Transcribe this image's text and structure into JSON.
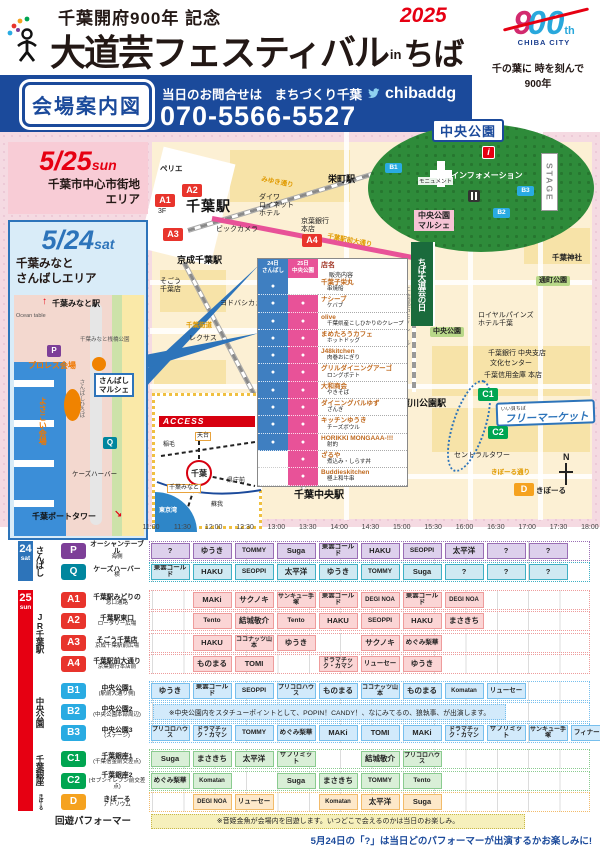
{
  "header": {
    "supertitle": "千葉開府900年 記念",
    "title_main": "大道芸フェスティバル",
    "title_in": "in",
    "title_chiba": "ちば",
    "year": "2025",
    "logo_9": "9",
    "logo_00": "00",
    "logo_th": "th",
    "logo_city": "CHIBA CITY",
    "tagline": "千の葉に 時を刻んで\n900年"
  },
  "contact": {
    "map_label": "会場案内図",
    "inquiry": "当日のお問合せは　まちづくり千葉",
    "twitter": "chibaddg",
    "phone": "070-5566-5527"
  },
  "sun_area": {
    "date": "5/25",
    "day": "sun",
    "area": "千葉市中心市街地\nエリア"
  },
  "sat_area": {
    "date": "5/24",
    "day": "sat",
    "area": "千葉みなと\nさんばしエリア"
  },
  "park": {
    "title": "中央公園",
    "stage": "STAGE",
    "monument": "モニュメント",
    "information": "インフォメーション",
    "info_i": "i",
    "marche": "中央公園\nマルシェ",
    "nobori": "ちば大道芸の日",
    "badges": [
      {
        "t": "B1",
        "x": 385,
        "y": 31,
        "c": "",
        "n": "park-point-b1"
      },
      {
        "t": "B3",
        "x": 517,
        "y": 54,
        "c": "",
        "n": "park-point-b3"
      },
      {
        "t": "B2",
        "x": 493,
        "y": 76,
        "c": "",
        "n": "park-point-b2"
      }
    ]
  },
  "map_texts": {
    "flea_small": "いい貝ちば",
    "flea_big": "フリーマーケット",
    "north": "N"
  },
  "main_map": {
    "labels": [
      {
        "t": "ペリエ",
        "x": 160,
        "y": 33,
        "c": "m-lbl-b",
        "n": "perie-label"
      },
      {
        "t": "千葉駅",
        "x": 186,
        "y": 66,
        "c": "m-sta-lg",
        "n": "chiba-station-label"
      },
      {
        "t": "京成千葉駅",
        "x": 177,
        "y": 123,
        "c": "m-sta",
        "n": "keisei-chiba-station-label"
      },
      {
        "t": "栄町駅",
        "x": 328,
        "y": 42,
        "c": "m-sta",
        "n": "sakaecho-station-label"
      },
      {
        "t": "千葉中央駅",
        "x": 294,
        "y": 358,
        "c": "m-sta-md",
        "n": "chiba-chuo-station-label"
      },
      {
        "t": "葭川公園駅",
        "x": 401,
        "y": 266,
        "c": "m-sta",
        "n": "yoshikawa-koen-station-label"
      },
      {
        "t": "3F",
        "x": 158,
        "y": 76,
        "c": "m-lbl",
        "n": "a1-floor-label"
      },
      {
        "t": "ビックカメラ",
        "x": 216,
        "y": 94,
        "c": "m-lbl",
        "n": "bic-camera-label"
      },
      {
        "t": "ダイワ\nロイネット\nホテル",
        "x": 259,
        "y": 62,
        "c": "m-lbl",
        "n": "daiwa-roynet-label"
      },
      {
        "t": "京葉銀行\n本店",
        "x": 301,
        "y": 86,
        "c": "m-lbl",
        "n": "keiyo-bank-label"
      },
      {
        "t": "そごう\n千葉店",
        "x": 160,
        "y": 146,
        "c": "m-lbl",
        "n": "sogo-label"
      },
      {
        "t": "ヨドバシカメラ",
        "x": 220,
        "y": 168,
        "c": "m-lbl",
        "n": "yodobashi-label"
      },
      {
        "t": "レクサス",
        "x": 189,
        "y": 203,
        "c": "m-lbl",
        "n": "lexus-label"
      },
      {
        "t": "千葉街道",
        "x": 186,
        "y": 190,
        "c": "m-road",
        "n": "chiba-kaido-label"
      },
      {
        "t": "みゆき通り",
        "x": 262,
        "y": 44,
        "c": "m-road m-road-rot",
        "n": "miyuki-street-label"
      },
      {
        "t": "千葉駅前大通り",
        "x": 328,
        "y": 101,
        "c": "m-road m-road-rot",
        "n": "ekimae-avenue-label"
      },
      {
        "t": "千葉神社",
        "x": 552,
        "y": 122,
        "c": "m-lbl-b",
        "n": "chiba-shrine-label"
      },
      {
        "t": "通町公園",
        "x": 536,
        "y": 144,
        "c": "m-chip",
        "n": "torichou-park-label"
      },
      {
        "t": "ロイヤルパインズ\nホテル千葉",
        "x": 478,
        "y": 180,
        "c": "m-lbl",
        "n": "royal-pines-label"
      },
      {
        "t": "中央公園",
        "x": 430,
        "y": 195,
        "c": "m-chip",
        "n": "chuo-park-small-label"
      },
      {
        "t": "千葉銀行 中央支店",
        "x": 488,
        "y": 218,
        "c": "m-lbl",
        "n": "chiba-bank-label"
      },
      {
        "t": "文化センター",
        "x": 490,
        "y": 228,
        "c": "m-lbl",
        "n": "culture-center-label"
      },
      {
        "t": "千葉信用金庫 本店",
        "x": 484,
        "y": 240,
        "c": "m-lbl",
        "n": "shinkin-bank-label"
      },
      {
        "t": "セントラルタワー",
        "x": 454,
        "y": 320,
        "c": "m-lbl",
        "n": "central-tower-label"
      },
      {
        "t": "きぼーる通り",
        "x": 491,
        "y": 337,
        "c": "m-road",
        "n": "qiball-street-label"
      },
      {
        "t": "きぼーる",
        "x": 536,
        "y": 355,
        "c": "m-lbl-b",
        "n": "qiball-label"
      },
      {
        "t": "千葉都市モノレール",
        "x": 402,
        "y": 155,
        "c": "m-v",
        "n": "monorail-label"
      }
    ],
    "badges": [
      {
        "t": "A1",
        "x": 155,
        "y": 62,
        "c": "bA",
        "n": "point-a1-badge"
      },
      {
        "t": "A2",
        "x": 182,
        "y": 52,
        "c": "bA",
        "n": "point-a2-badge"
      },
      {
        "t": "A3",
        "x": 163,
        "y": 96,
        "c": "bA",
        "n": "point-a3-badge"
      },
      {
        "t": "A4",
        "x": 302,
        "y": 102,
        "c": "bA",
        "n": "point-a4-badge"
      },
      {
        "t": "C1",
        "x": 478,
        "y": 256,
        "c": "bC",
        "n": "point-c1-badge"
      },
      {
        "t": "C2",
        "x": 488,
        "y": 294,
        "c": "bC",
        "n": "point-c2-badge"
      },
      {
        "t": "D",
        "x": 514,
        "y": 351,
        "c": "bD",
        "n": "point-d-badge"
      }
    ]
  },
  "minato": {
    "elements": [
      {
        "t": "↑",
        "x": 28,
        "y": 1,
        "c": "mm-arr",
        "n": "up-arrow-icon"
      },
      {
        "t": "千葉みなと駅",
        "x": 38,
        "y": 4,
        "c": "mm-sta",
        "n": "chibaminato-station-label"
      },
      {
        "t": "Ocean table",
        "x": 2,
        "y": 18,
        "c": "mm-tiny",
        "n": "ocean-table-label"
      },
      {
        "t": "千葉みなと桟橋公園",
        "x": 66,
        "y": 42,
        "c": "mm-tiny",
        "n": "sanbashi-park-label"
      },
      {
        "t": "P",
        "x": 33,
        "y": 50,
        "c": "mm-badge bP",
        "n": "point-p-badge"
      },
      {
        "t": "プロレス会場",
        "x": 14,
        "y": 66,
        "c": "mm-orange",
        "n": "wrestling-venue-label"
      },
      {
        "t": "さんばし\nマルシェ",
        "x": 80,
        "y": 78,
        "c": "mm-marche",
        "n": "sanbashi-marche-label"
      },
      {
        "t": "さんばしひろば",
        "x": 64,
        "y": 84,
        "c": "mm-v-grey",
        "n": "sanbashi-hiroba-label"
      },
      {
        "t": "よさこい会場",
        "x": 24,
        "y": 102,
        "c": "mm-v-orange",
        "n": "yosakoi-venue-label"
      },
      {
        "t": "Q",
        "x": 89,
        "y": 142,
        "c": "mm-badge bQ",
        "n": "point-q-badge"
      },
      {
        "t": "ケーズハーバー",
        "x": 58,
        "y": 176,
        "c": "mm-lbl",
        "n": "ks-harbor-label"
      },
      {
        "t": "千葉ポートタワー",
        "x": 18,
        "y": 217,
        "c": "mm-sta",
        "n": "port-tower-label"
      },
      {
        "t": "↘",
        "x": 100,
        "y": 214,
        "c": "mm-arr",
        "n": "down-right-arrow-icon"
      }
    ]
  },
  "access": {
    "title": "ACCESS",
    "elements": [
      {
        "t": "稲毛",
        "x": 8,
        "y": 46,
        "c": "acc-lbl",
        "n": "inage-label"
      },
      {
        "t": "天台",
        "x": 40,
        "y": 36,
        "c": "acc-chip",
        "n": "tendai-label"
      },
      {
        "t": "千葉",
        "x": 31,
        "y": 64,
        "c": "acc-chiba",
        "n": "chiba-circle-label"
      },
      {
        "t": "県庁前",
        "x": 72,
        "y": 82,
        "c": "acc-lbl",
        "n": "kencho-mae-label"
      },
      {
        "t": "千葉みなと",
        "x": 12,
        "y": 88,
        "c": "acc-chip",
        "n": "chibaminato-label"
      },
      {
        "t": "蘇我",
        "x": 56,
        "y": 106,
        "c": "acc-lbl",
        "n": "soga-label"
      },
      {
        "t": "東京湾",
        "x": 4,
        "y": 112,
        "c": "acc-sea",
        "n": "tokyo-bay-label"
      }
    ]
  },
  "vendor_table": {
    "dot": "●",
    "header_sat": "24日\nさんばし",
    "header_sun": "25日\n中央公園",
    "header_name": "店名",
    "header_desc": "販売内容",
    "rows": [
      {
        "n": "千葉子栄丸",
        "d": "串焼船",
        "sat": 1,
        "sun": 0
      },
      {
        "n": "ナシーブ",
        "d": "ケバブ",
        "sat": 1,
        "sun": 1
      },
      {
        "n": "olive",
        "d": "千葉県産こしひかりのクレープ",
        "sat": 1,
        "sun": 1
      },
      {
        "n": "まめたろうカフェ",
        "d": "ホットドッグ",
        "sat": 1,
        "sun": 1
      },
      {
        "n": "J48kitchen",
        "d": "肉巻おにぎり",
        "sat": 1,
        "sun": 1
      },
      {
        "n": "グリルダイニングアーゴ",
        "d": "ロングポテト",
        "sat": 1,
        "sun": 1
      },
      {
        "n": "大和商会",
        "d": "やきそば",
        "sat": 1,
        "sun": 1
      },
      {
        "n": "ダイニングバルゆず",
        "d": "ざんぎ",
        "sat": 1,
        "sun": 1
      },
      {
        "n": "キッチンゆうき",
        "d": "チーズボウル",
        "sat": 1,
        "sun": 1
      },
      {
        "n": "HORIKKI MONGAAA-!!!",
        "d": "射的",
        "sat": 1,
        "sun": 1
      },
      {
        "n": "ざるや",
        "d": "煮込み・しらす丼",
        "sat": 0,
        "sun": 1
      },
      {
        "n": "Buddieskitchen",
        "d": "極上和牛串",
        "sat": 0,
        "sun": 1
      }
    ]
  },
  "colors": {
    "p": {
      "bg": "#ddd0ec",
      "bd": "#9a6fb5",
      "badge": "#7d3f98"
    },
    "q": {
      "bg": "#cfe9f2",
      "bd": "#3fb0c4",
      "badge": "#00869e"
    },
    "a": {
      "bg": "#fbd5d5",
      "bd": "#ee9c9c",
      "badge": "#e8342c"
    },
    "b": {
      "bg": "#d2eafb",
      "bd": "#77bfed",
      "badge": "#29abe2"
    },
    "c": {
      "bg": "#d9efd7",
      "bd": "#8bcb90",
      "badge": "#00a551"
    },
    "d": {
      "bg": "#fde8c9",
      "bd": "#f2bb6a",
      "badge": "#f5a21f"
    }
  },
  "schedule": {
    "times": [
      "11:00",
      "11:30",
      "12:00",
      "12:30",
      "13:00",
      "13:30",
      "14:00",
      "14:30",
      "15:00",
      "15:30",
      "16:00",
      "16:30",
      "17:00",
      "17:30",
      "18:00"
    ],
    "day_groups": [
      {
        "num": "24",
        "day": "sat",
        "top": 0,
        "h": 40,
        "color": "#2d74ba"
      },
      {
        "num": "25",
        "day": "sun",
        "top": 49,
        "h": 221,
        "color": "#e60012"
      }
    ],
    "area_groups": [
      {
        "label": "さんばし",
        "top": 0,
        "h": 40
      },
      {
        "label": "JR千葉駅",
        "top": 49,
        "h": 84
      },
      {
        "label": "中央公園",
        "top": 140,
        "h": 61
      },
      {
        "label": "千葉銀座",
        "top": 208,
        "h": 41
      },
      {
        "label": "きぼーる",
        "top": 251,
        "h": 19
      }
    ],
    "rows": [
      {
        "grp": "p",
        "badge": "P",
        "place": "オーシャンテーブル",
        "place2": "海側",
        "top": 0,
        "lead": 0,
        "cells": [
          "?",
          "ゆうき",
          "TOMMY",
          "Suga",
          "東雲ゴールド",
          "HAKU",
          "SEOPPI",
          "太平洋",
          "?",
          "?"
        ]
      },
      {
        "grp": "q",
        "badge": "Q",
        "place": "ケーズハーバー",
        "place2": "横",
        "top": 21,
        "lead": 0,
        "cells": [
          "東雲ゴールド",
          "HAKU",
          "SEOPPI",
          "太平洋",
          "ゆうき",
          "TOMMY",
          "Suga",
          "?",
          "?",
          "?"
        ]
      },
      {
        "grp": "a",
        "badge": "A1",
        "place": "千葉駅みどりの",
        "place2": "窓口通路",
        "top": 49,
        "lead": 1,
        "cells": [
          "MAKi",
          "サクノキ",
          "サンキュー手塚",
          "東雲ゴールド",
          "DEGI NOA",
          "東雲ゴールド",
          "DEGI NOA"
        ]
      },
      {
        "grp": "a",
        "badge": "A2",
        "place": "千葉駅東口",
        "place2": "ロータリー広場",
        "top": 70,
        "lead": 1,
        "cells": [
          "Tento",
          "結城敬介",
          "Tento",
          "HAKU",
          "SEOPPI",
          "HAKU",
          "まさきち"
        ]
      },
      {
        "grp": "a",
        "badge": "A3",
        "place": "そごう千葉店",
        "place2": "京成千葉駅前広場",
        "top": 92,
        "lead": 1,
        "cells": [
          "HAKU",
          "ココナッツ山本",
          "ゆうき",
          null,
          "サクノキ",
          "めぐみ梨華"
        ]
      },
      {
        "grp": "a",
        "badge": "A4",
        "place": "千葉駅前大通り",
        "place2": "京葉銀行本店前",
        "top": 113,
        "lead": 1,
        "cells": [
          "ものまる",
          "TOMI",
          null,
          "ドラマチック・カマン",
          "リューセー",
          "ゆうき"
        ]
      },
      {
        "grp": "b",
        "badge": "B1",
        "place": "中央公園1",
        "place2": "(駅前大通り側)",
        "top": 140,
        "lead": 0,
        "cells": [
          "ゆうき",
          "東雲ゴールド",
          "SEOPPI",
          "プリコロハウス",
          "ものまる",
          "ココナッツ山本",
          "ものまる",
          "Komatan",
          "リューセー"
        ]
      },
      {
        "grp": "b",
        "badge": "B2",
        "place": "中央公園2",
        "place2": "(中央公園本部周辺)",
        "top": 161,
        "banner": "※中央公園内をスタチューポイントとして、POPIN！CANDY！、なにみてるの、狼執事、が出演します。"
      },
      {
        "grp": "b",
        "badge": "B3",
        "place": "中央公園3",
        "place2": "(ステージ)",
        "top": 182,
        "lead": 0,
        "cells": [
          "プリコロハウス",
          "ドラマチック・カマン",
          "TOMMY",
          "めぐみ梨華",
          "MAKi",
          "TOMI",
          "MAKi",
          "ドラマチック・カマン",
          "サプリミット",
          "サンキュー手塚",
          "フィナーレ"
        ]
      },
      {
        "grp": "c",
        "badge": "C1",
        "place": "千葉銀座1",
        "place2": "(千葉信金前交差点)",
        "top": 208,
        "lead": 0,
        "cells": [
          "Suga",
          "まさきち",
          "太平洋",
          "サプリミット",
          null,
          "結城敬介",
          "プリコロハウス"
        ]
      },
      {
        "grp": "c",
        "badge": "C2",
        "place": "千葉銀座2",
        "place2": "(セブンイレブン前交差点)",
        "top": 230,
        "lead": 0,
        "cells": [
          "めぐみ梨華",
          "Komatan",
          null,
          "Suga",
          "まさきち",
          "TOMMY",
          "Tento"
        ]
      },
      {
        "grp": "d",
        "badge": "D",
        "place": "きぼーる",
        "place2": "アトリウム",
        "top": 251,
        "lead": 1,
        "cells": [
          "DEGI NOA",
          "リューセー",
          null,
          "Komatan",
          "太平洋",
          "Suga"
        ]
      }
    ],
    "roam": {
      "label": "回遊パフォーマー",
      "note": "※音姫金魚が会場内を回遊します。いつどこで会えるのかは当日のお楽しみ。"
    },
    "footnote": "5月24日の「?」は当日どのパフォーマーが出演するかお楽しみに!"
  }
}
